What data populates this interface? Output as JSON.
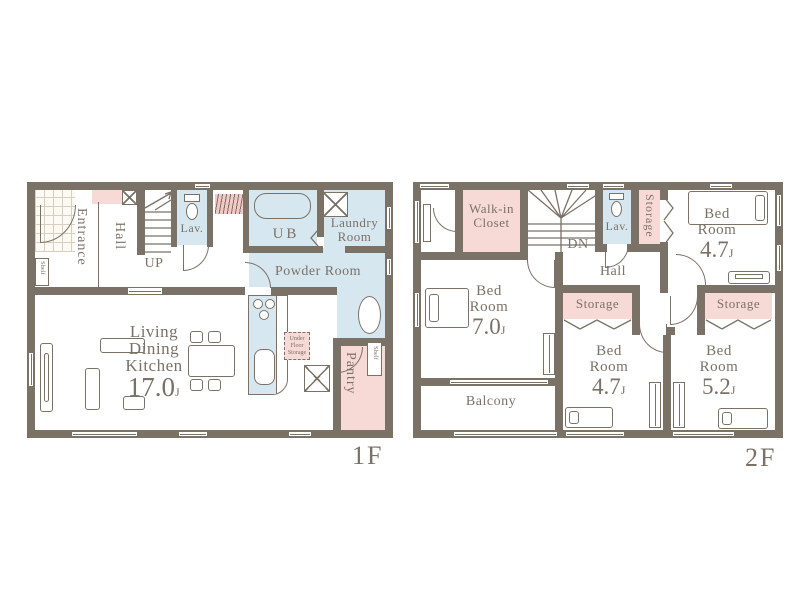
{
  "colors": {
    "wall": "#7b7267",
    "pink": "#f7d9d5",
    "blue": "#d7e7f0",
    "text": "#7b7267"
  },
  "floor1": {
    "label": "1F",
    "entrance": "Entrance",
    "hall": "Hall",
    "up": "UP",
    "lav": "Lav.",
    "ub": "UB",
    "laundry_l1": "Laundry",
    "laundry_l2": "Room",
    "powder_room": "Powder Room",
    "ldk_l1": "Living",
    "ldk_l2": "Dining",
    "ldk_l3": "Kitchen",
    "ldk_size": "17.0",
    "ldk_unit": "J",
    "ufs_l1": "Under",
    "ufs_l2": "Floor",
    "ufs_l3": "Storage",
    "pantry": "Pantry",
    "shelf_entrance": "Shelf",
    "shelf_pantry": "Shelf"
  },
  "floor2": {
    "label": "2F",
    "walkin_l1": "Walk-in",
    "walkin_l2": "Closet",
    "dn": "DN",
    "lav": "Lav.",
    "hall": "Hall",
    "storage_top": "Storage",
    "storage_mid": "Storage",
    "storage_right": "Storage",
    "balcony": "Balcony",
    "bedroom_tr": {
      "l1": "Bed",
      "l2": "Room",
      "size": "4.7",
      "unit": "J"
    },
    "bedroom_left": {
      "l1": "Bed",
      "l2": "Room",
      "size": "7.0",
      "unit": "J"
    },
    "bedroom_bc": {
      "l1": "Bed",
      "l2": "Room",
      "size": "4.7",
      "unit": "J"
    },
    "bedroom_br": {
      "l1": "Bed",
      "l2": "Room",
      "size": "5.2",
      "unit": "J"
    }
  }
}
